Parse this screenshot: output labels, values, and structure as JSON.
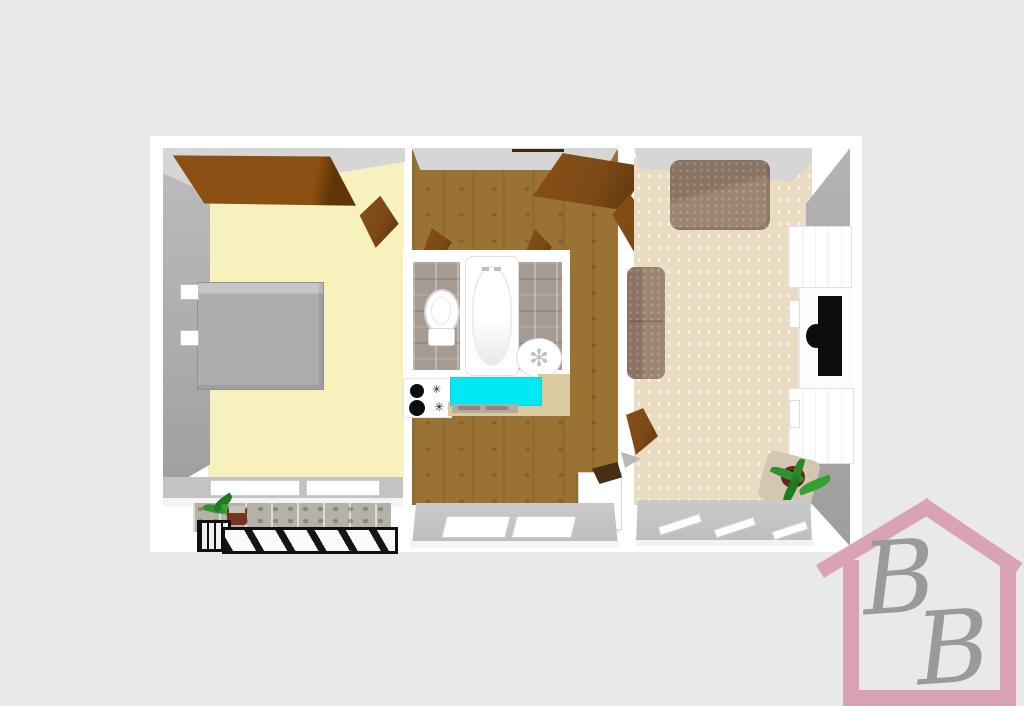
{
  "canvas": {
    "background_color": "#e9e9e9"
  },
  "floorplan": {
    "type": "3d-floor-plan-top-view",
    "wall_color": "#ffffff",
    "rooms": [
      {
        "id": "bedroom",
        "floor_color": "#f7f2bd",
        "furniture": [
          "wardrobe",
          "double-bed",
          "pillows",
          "open-door",
          "window",
          "balcony",
          "potted-plant",
          "striped-railing"
        ]
      },
      {
        "id": "hallway-kitchen",
        "floor_color": "#9a7334",
        "furniture": [
          "entry-door",
          "toilet",
          "bathtub",
          "round-sink",
          "stove-with-burners",
          "cyan-countertop",
          "fridge",
          "window",
          "interior-doors"
        ]
      },
      {
        "id": "living-room",
        "floor_color": "#e9dcc2",
        "furniture": [
          "sofa",
          "second-sofa",
          "tv-wall-unit",
          "tv",
          "potted-plant",
          "window",
          "open-doors"
        ]
      }
    ],
    "accent_colors": {
      "door_wood": "#7c4a16",
      "wardrobe_wood": "#8d4e13",
      "countertop_cyan": "#00e9f2",
      "sofa_upholstery": "#9d8671",
      "bed_gray": "#adadad",
      "balcony_stone": "#b4b1a7"
    }
  },
  "icons": {
    "burner_knob_glyph": "✳",
    "sink_flower_glyph": "✻"
  },
  "logo": {
    "letters": [
      "B",
      "B"
    ],
    "house_color": "#d9a2b6",
    "letter_color": "#9a9a9a"
  }
}
